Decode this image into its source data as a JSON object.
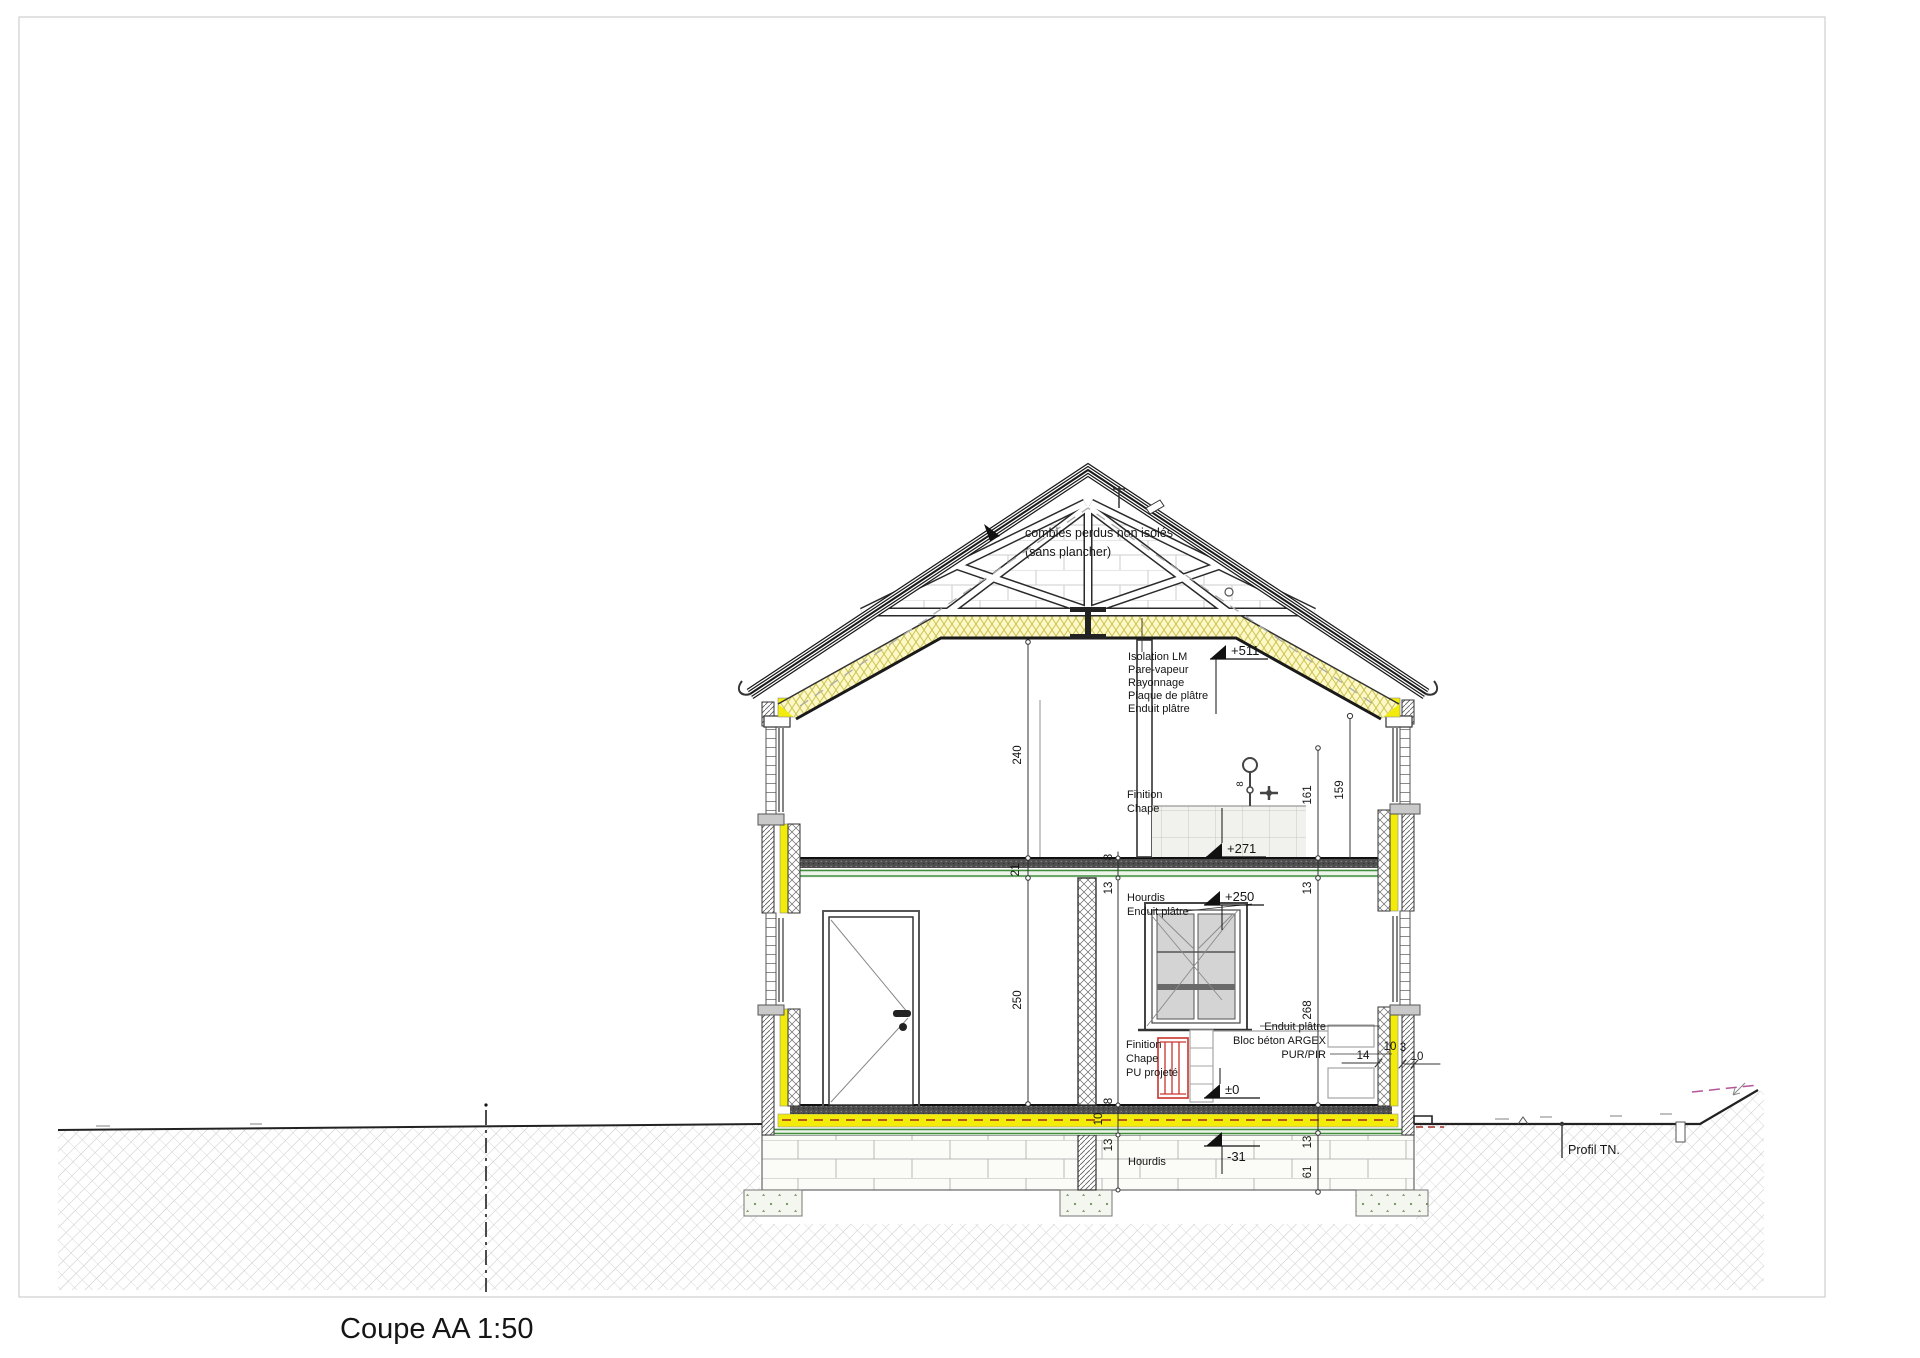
{
  "drawing": {
    "title": "Coupe AA 1:50",
    "attic_note_line1": "combles perdus non isolés",
    "attic_note_line2": "(sans plancher)",
    "roof_buildup": [
      "Isolation LM",
      "Pare-vapeur",
      "Rayonnage",
      "Plaque de plâtre",
      "Enduit plâtre"
    ],
    "ff_floor_finish": [
      "Finition",
      "Chape"
    ],
    "ff_slab": [
      "Hourdis",
      "Enduit plâtre"
    ],
    "gf_floor_finish": [
      "Finition",
      "Chape",
      "PU projeté"
    ],
    "ext_wall_buildup": [
      "Enduit plâtre",
      "Bloc béton ARGEX",
      "PUR/PIR"
    ],
    "foundation_slab_label": "Hourdis",
    "terrain_label": "Profil TN.",
    "levels": {
      "ceiling": "+511",
      "ff_finished": "+271",
      "ff_structural": "+250",
      "gf_finished": "±0",
      "gf_structural": "-31"
    },
    "dims": {
      "ff_height": "240",
      "gf_height": "250",
      "gf_clear": "268",
      "c161": "161",
      "c159": "159",
      "slab21": "21",
      "chape8": "8",
      "plaster13": "13",
      "tile8": "8",
      "g8": "8",
      "g10": "10",
      "g13": "13",
      "f13": "13",
      "f61": "61",
      "w14": "14",
      "w10a": "10",
      "w3": "3",
      "w10b": "10"
    },
    "colors": {
      "insulation_yellow": "#f3ec0a",
      "insulation_pale": "#fcf8c8",
      "screed_green": "#3f8f3f",
      "radiator_red": "#c9342c",
      "boundary_magenta": "#b4559b"
    }
  }
}
